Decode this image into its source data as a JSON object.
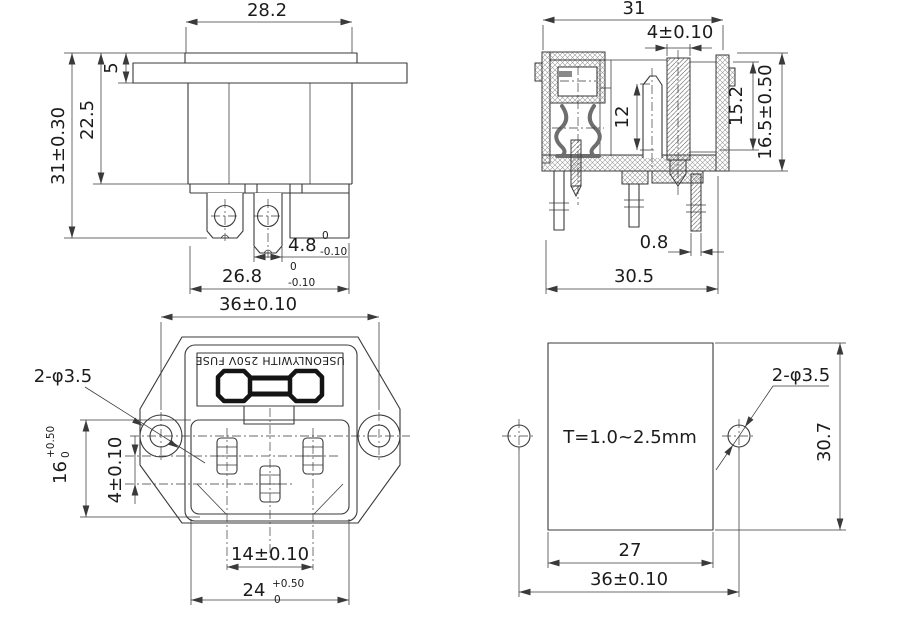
{
  "drawing": {
    "colors": {
      "line": "#3a3a3a",
      "text": "#1c1c1c",
      "background": "#ffffff",
      "clip_gray": "#6e6e6e",
      "fuse_black": "#141414"
    },
    "views": {
      "side": {
        "dims": {
          "top_width": "28.2",
          "flange_thickness": "5",
          "body_depth": "22.5",
          "total_depth": "31±0.30",
          "tab_width": "4.8",
          "tab_tol_upper": "0",
          "tab_tol_lower": "-0.10",
          "lower_width": "26.8",
          "lower_tol_upper": "0",
          "lower_tol_lower": "-0.10"
        }
      },
      "section": {
        "dims": {
          "top_width": "31",
          "slot_width": "4±0.10",
          "contact_length": "12",
          "inner_height": "15.2",
          "outer_height": "16.5±0.50",
          "pin_thickness": "0.8",
          "bottom_width": "30.5"
        }
      },
      "front": {
        "fuse_label": "USEONLYWITH 250V FUSE",
        "dims": {
          "hole_pitch": "36±0.10",
          "holes": "2-φ3.5",
          "recess_height": "16",
          "recess_height_tol_upper": "+0.50",
          "recess_height_tol_lower": "0",
          "pin_row_offset": "4±0.10",
          "pin_pitch": "14±0.10",
          "recess_width": "24",
          "recess_width_tol_upper": "+0.50",
          "recess_width_tol_lower": "0"
        }
      },
      "cutout": {
        "panel_thickness_label": "T=1.0~2.5mm",
        "dims": {
          "holes": "2-φ3.5",
          "cut_height": "30.7",
          "cut_width": "27",
          "hole_pitch": "36±0.10"
        }
      }
    }
  }
}
